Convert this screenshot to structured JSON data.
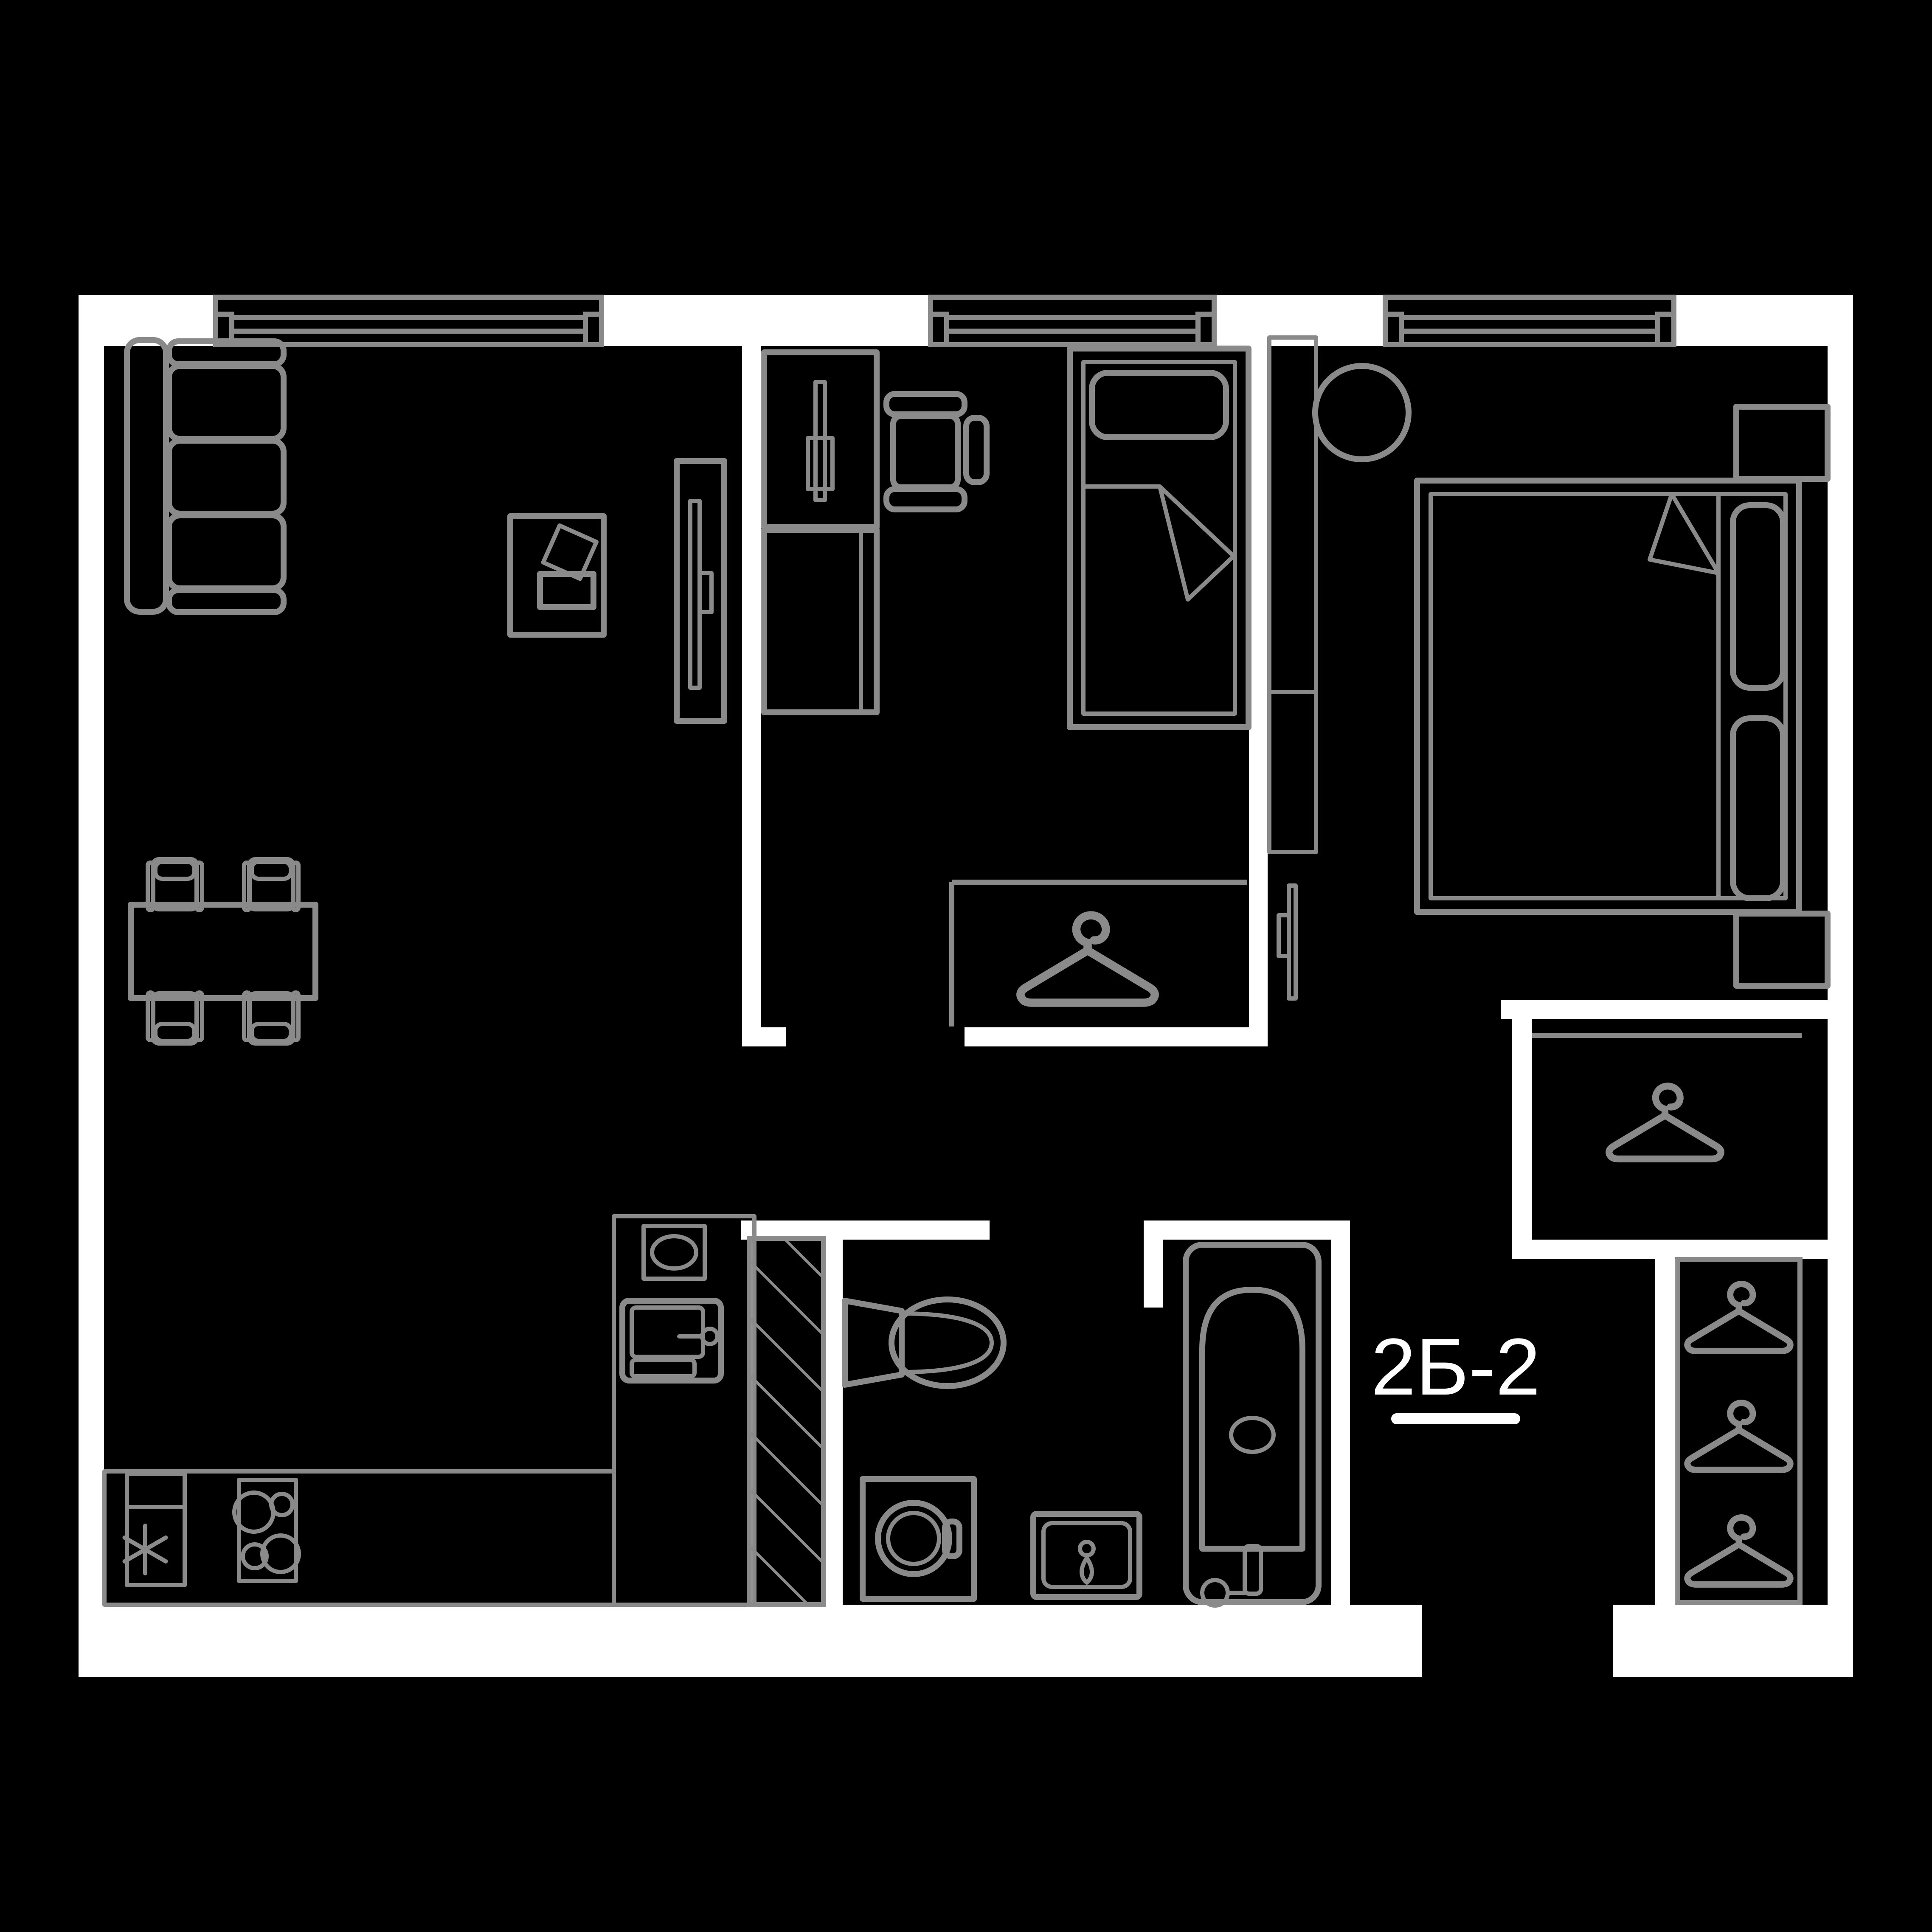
{
  "plan": {
    "label": "2Б-2",
    "colors": {
      "background": "#000000",
      "wall": "#ffffff",
      "furniture": "#8a8a8a",
      "label": "#ffffff"
    },
    "icons": {
      "hanger": "hanger-icon",
      "snowflake": "snowflake-icon"
    }
  }
}
